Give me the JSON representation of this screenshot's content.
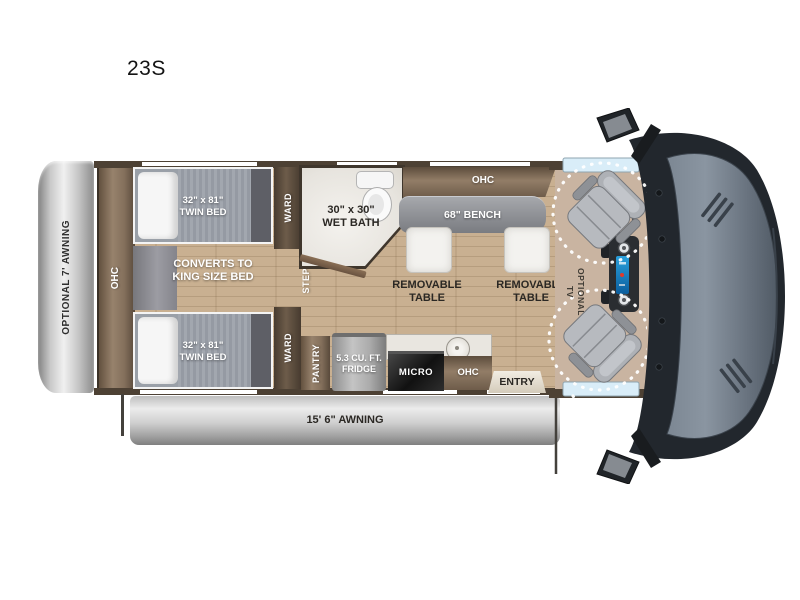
{
  "title": "23S",
  "labels": {
    "optional_awning": "OPTIONAL 7' AWNING",
    "main_awning": "15' 6\" AWNING",
    "rear_ohc": "OHC",
    "twin_bed_top": "32\" x 81\"\nTWIN BED",
    "twin_bed_bottom": "32\" x 81\"\nTWIN BED",
    "king_bed": "CONVERTS TO\nKING SIZE BED",
    "ward_top": "WARD",
    "ward_bottom": "WARD",
    "step": "STEP",
    "wet_bath": "30\" x 30\"\nWET BATH",
    "galley_ohc": "OHC",
    "bench": "68\" BENCH",
    "table_left": "REMOVABLE\nTABLE",
    "table_right": "REMOVABLE\nTABLE",
    "optional_tv": "OPTIONAL\nTV",
    "pantry": "PANTRY",
    "fridge": "5.3 CU. FT.\nFRIDGE",
    "micro": "MICRO",
    "kitchen_ohc": "OHC",
    "entry": "ENTRY"
  },
  "colors": {
    "wall": "#4d4134",
    "cabinet_brown": "#8a7560",
    "wood_floor": "#c3aa8c",
    "bench_gray": "#8b8d92",
    "awning_gray": "#c6c6c6",
    "cab_floor_tan": "#c9b4a1",
    "window_blue": "#d9edf8",
    "hood_gray_blue": "#7c8793",
    "dash_line": "#ffffff"
  }
}
